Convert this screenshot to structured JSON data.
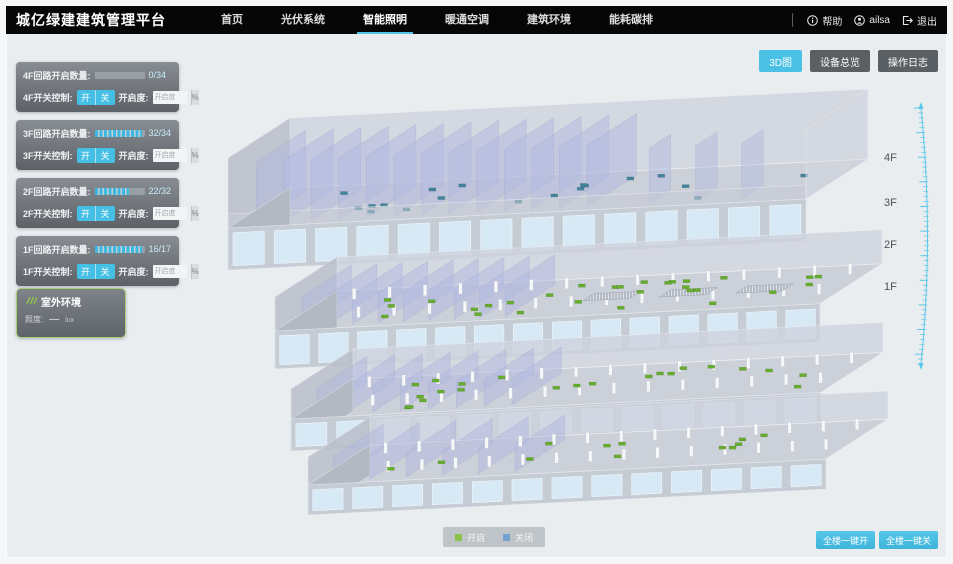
{
  "header": {
    "title": "城亿绿建建筑管理平台",
    "nav": [
      {
        "label": "首页"
      },
      {
        "label": "光伏系统"
      },
      {
        "label": "智能照明"
      },
      {
        "label": "暖通空调"
      },
      {
        "label": "建筑环境"
      },
      {
        "label": "能耗碳排"
      }
    ],
    "active_nav": "智能照明",
    "help_label": "帮助",
    "user_name": "ailsa",
    "logout_label": "退出"
  },
  "toolbar": {
    "view_3d_label": "3D图",
    "device_overview_label": "设备总览",
    "operation_log_label": "操作日志"
  },
  "floor_panels": [
    {
      "floor": "4F",
      "count_label": "4F回路开启数量:",
      "open": 0,
      "total": 34,
      "count_value": "0/34",
      "switch_label": "4F开关控制:",
      "on_label": "开",
      "off_label": "关",
      "dim_label": "开启度:",
      "dim_placeholder": "开启度",
      "percent_label": "%"
    },
    {
      "floor": "3F",
      "count_label": "3F回路开启数量:",
      "open": 32,
      "total": 34,
      "count_value": "32/34",
      "switch_label": "3F开关控制:",
      "on_label": "开",
      "off_label": "关",
      "dim_label": "开启度:",
      "dim_placeholder": "开启度",
      "percent_label": "%"
    },
    {
      "floor": "2F",
      "count_label": "2F回路开启数量:",
      "open": 22,
      "total": 32,
      "count_value": "22/32",
      "switch_label": "2F开关控制:",
      "on_label": "开",
      "off_label": "关",
      "dim_label": "开启度:",
      "dim_placeholder": "开启度",
      "percent_label": "%"
    },
    {
      "floor": "1F",
      "count_label": "1F回路开启数量:",
      "open": 16,
      "total": 17,
      "count_value": "16/17",
      "switch_label": "1F开关控制:",
      "on_label": "开",
      "off_label": "关",
      "dim_label": "开启度:",
      "dim_placeholder": "开启度",
      "percent_label": "%"
    }
  ],
  "outdoor_panel": {
    "title": "室外环境",
    "metric_label": "照度:",
    "metric_value": "—",
    "metric_unit": "lux"
  },
  "floor_labels": [
    "4F",
    "3F",
    "2F",
    "1F"
  ],
  "legend": {
    "on_label": "开启",
    "on_color": "#8bc34a",
    "off_label": "关闭",
    "off_color": "#74a3d2"
  },
  "bottom_buttons": {
    "all_on_label": "全楼一键开",
    "all_off_label": "全楼一键关"
  },
  "colors": {
    "accent": "#49c0e4",
    "header_bg": "#060606",
    "light_on": "#66ad2e",
    "light_off": "#43839e"
  }
}
